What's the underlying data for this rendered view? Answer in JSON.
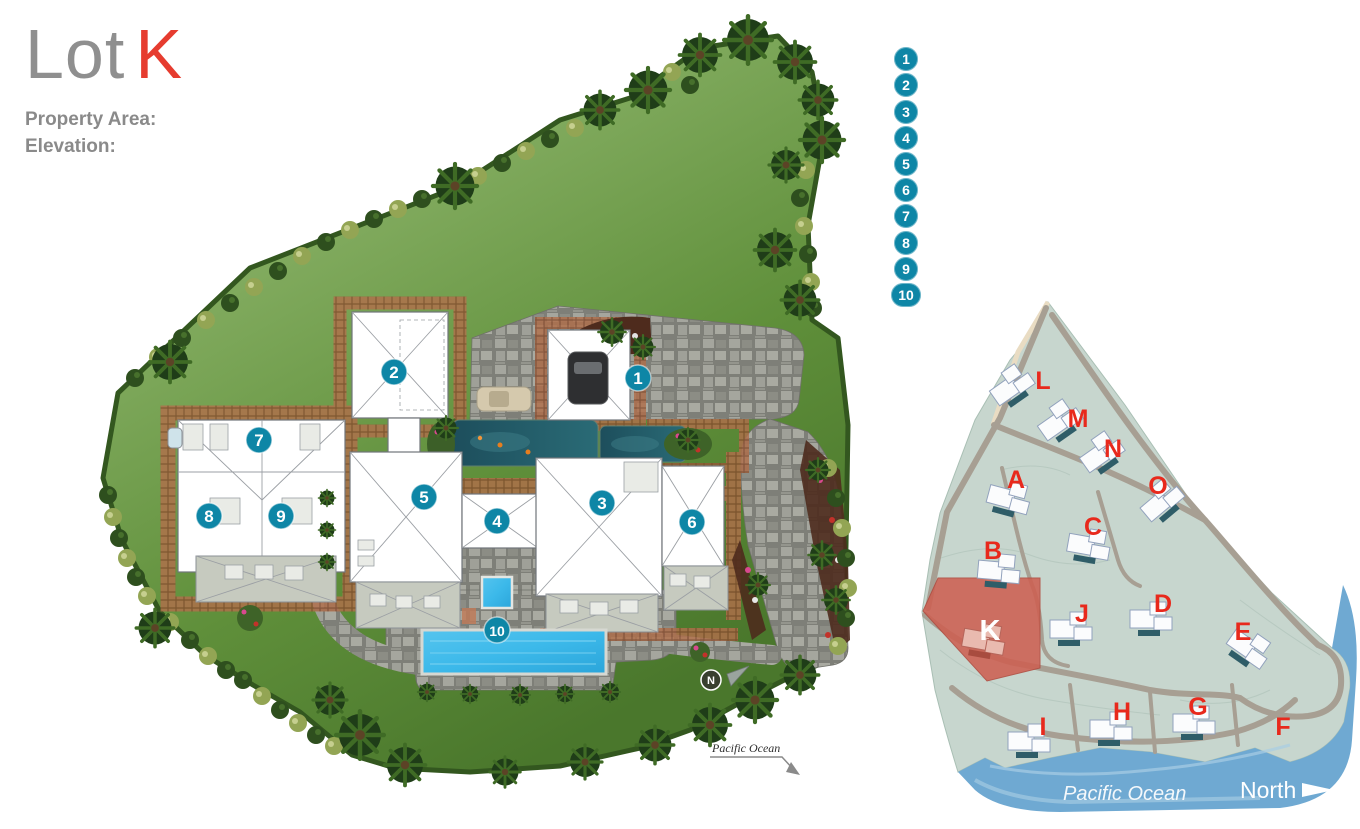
{
  "header": {
    "title_prefix": "Lot",
    "title_lot": "K",
    "property_area_label": "Property Area:",
    "elevation_label": "Elevation:"
  },
  "legend": {
    "items": [
      "1",
      "2",
      "3",
      "4",
      "5",
      "6",
      "7",
      "8",
      "9",
      "10"
    ]
  },
  "plan": {
    "markers": [
      "1",
      "2",
      "3",
      "4",
      "5",
      "6",
      "7",
      "8",
      "9",
      "10"
    ],
    "compass_label": "N",
    "ocean_note_label": "Pacific Ocean"
  },
  "map": {
    "lots": [
      "L",
      "M",
      "N",
      "O",
      "A",
      "C",
      "B",
      "J",
      "D",
      "E",
      "K",
      "I",
      "H",
      "G",
      "F"
    ],
    "highlighted_lot": "K",
    "ocean_label": "Pacific Ocean",
    "north_label": "North"
  },
  "colors": {
    "marker_teal": "#0e86a6",
    "lot_letter_red": "#e8291c",
    "lot_k_fill": "#cd6052",
    "water_blue": "#6fa9d2",
    "lawn_green": "#6f9e4a",
    "pool_blue": "#3cb9ea",
    "title_gray": "#8f8f8f",
    "title_red": "#e63c2f"
  }
}
